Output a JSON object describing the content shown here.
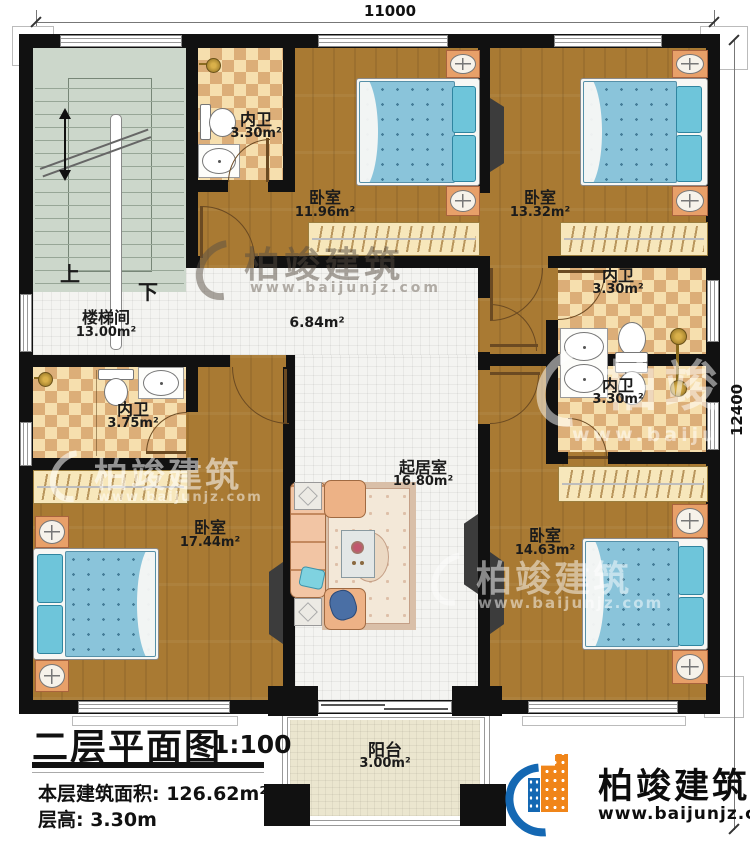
{
  "plan": {
    "dim_top": "11000",
    "dim_right": "12400",
    "rooms": {
      "stairwell": {
        "name": "楼梯间",
        "area": "13.00m²"
      },
      "hallway": {
        "area": "6.84m²"
      },
      "bath_top_left": {
        "name": "内卫",
        "area": "3.30m²"
      },
      "bedroom_top_mid": {
        "name": "卧室",
        "area": "11.96m²"
      },
      "bedroom_top_right": {
        "name": "卧室",
        "area": "13.32m²"
      },
      "bath_right_upper": {
        "name": "内卫",
        "area": "3.30m²"
      },
      "bath_right_lower": {
        "name": "内卫",
        "area": "3.30m²"
      },
      "bath_left": {
        "name": "内卫",
        "area": "3.75m²"
      },
      "bedroom_bottom_left": {
        "name": "卧室",
        "area": "17.44m²"
      },
      "living_room": {
        "name": "起居室",
        "area": "16.80m²"
      },
      "bedroom_bottom_right": {
        "name": "卧室",
        "area": "14.63m²"
      },
      "balcony": {
        "name": "阳台",
        "area": "3.00m²"
      }
    },
    "stairs": {
      "up_label": "上",
      "down_label": "下"
    }
  },
  "title_block": {
    "title": "二层平面图",
    "scale": "1:100",
    "floor_area": "本层建筑面积: 126.62m²",
    "floor_height": "层高: 3.30m"
  },
  "branding": {
    "company": "柏竣建筑",
    "website": "www.baijunjz.com"
  },
  "colors": {
    "wall": "#111111",
    "wood_floor": "#a97a33",
    "tile_floor": "#f4f4f1",
    "checker_light": "#f6dfae",
    "checker_dark": "#dcae78",
    "stairs": "#ccd7cb",
    "bed_blue": "#8ac4da",
    "pillow_cyan": "#6ec5da",
    "nightstand": "#e8a069",
    "wardrobe": "#f7e7bb",
    "logo_blue": "#1468b3",
    "logo_orange": "#f08519"
  }
}
